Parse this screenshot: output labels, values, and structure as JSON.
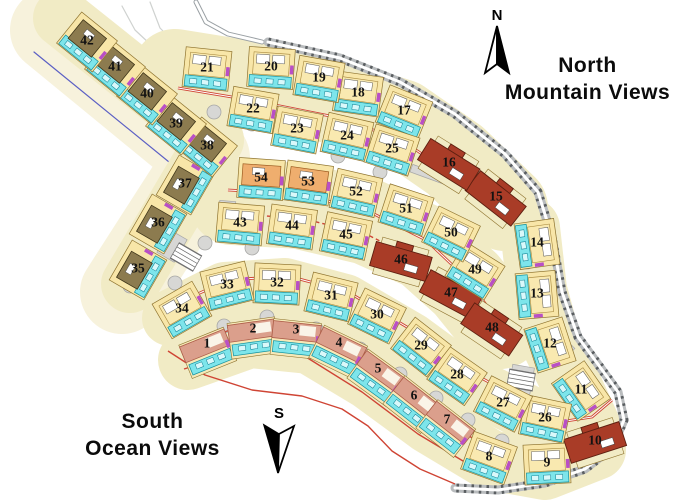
{
  "map": {
    "labels": {
      "north": {
        "line1": "North",
        "line2": "Mountain Views"
      },
      "south": {
        "line1": "South",
        "line2": "Ocean Views"
      },
      "compass_north": "N",
      "compass_south": "S"
    },
    "colors": {
      "ribbon": "#f1ebc5",
      "ribbon_light": "#f7f2dc",
      "cell": "#f8e6a8",
      "cell_stroke": "#8f7430",
      "building": "#f9e9b0",
      "building_stroke": "#a8883c",
      "terrace": "#7de5eb",
      "terrace_stroke": "#12919f",
      "olive": "#8c7b4f",
      "olive_stroke": "#3f3518",
      "orange": "#efae6e",
      "orange_stroke": "#9c5c20",
      "red": "#a93c27",
      "red_stroke": "#5d1f10",
      "salmon": "#db9f8c",
      "salmon_stroke": "#ae5d49",
      "red_line": "#cf4434",
      "magenta": "#b94fc6",
      "road_gray": "#b9bcbe",
      "road_dark": "#5a5e61",
      "circle_fill": "#d7d7d5",
      "circle_stroke": "#a8a8a6",
      "number": "#121212",
      "blue_edge": "#5b5fc4",
      "faint": "#cfd2d0"
    },
    "wedge": {
      "pts": [
        [
          52,
          30
        ],
        [
          208,
          158
        ],
        [
          122,
          292
        ]
      ],
      "w": 84
    },
    "blue_edge_pts": [
      [
        34,
        52
      ],
      [
        196,
        184
      ],
      [
        112,
        300
      ]
    ],
    "ribbons": [
      {
        "pts": [
          [
            62,
            18
          ],
          [
            215,
            140
          ]
        ],
        "w": 58
      },
      {
        "pts": [
          [
            215,
            140
          ],
          [
            130,
            284
          ]
        ],
        "w": 58
      },
      {
        "pts": [
          [
            175,
            72
          ],
          [
            250,
            84
          ],
          [
            330,
            100
          ],
          [
            400,
            122
          ],
          [
            455,
            160
          ],
          [
            505,
            208
          ]
        ],
        "w": 86
      },
      {
        "pts": [
          [
            232,
            202
          ],
          [
            300,
            206
          ],
          [
            368,
            222
          ],
          [
            426,
            248
          ],
          [
            466,
            284
          ],
          [
            500,
            326
          ]
        ],
        "w": 86
      },
      {
        "pts": [
          [
            530,
            228
          ],
          [
            537,
            290
          ],
          [
            552,
            345
          ],
          [
            574,
            390
          ],
          [
            590,
            425
          ]
        ],
        "w": 60
      },
      {
        "pts": [
          [
            170,
            318
          ],
          [
            225,
            290
          ],
          [
            285,
            286
          ],
          [
            345,
            302
          ],
          [
            410,
            340
          ],
          [
            470,
            384
          ],
          [
            542,
            420
          ]
        ],
        "w": 56
      },
      {
        "pts": [
          [
            188,
            360
          ],
          [
            250,
            338
          ],
          [
            310,
            344
          ],
          [
            370,
            380
          ],
          [
            430,
            424
          ],
          [
            490,
            460
          ],
          [
            545,
            470
          ],
          [
            596,
            450
          ]
        ],
        "w": 60
      }
    ],
    "roads": {
      "entrance": [
        [
          196,
          2
        ],
        [
          206,
          22
        ],
        [
          228,
          34
        ],
        [
          262,
          42
        ]
      ],
      "boundary": [
        [
          268,
          42
        ],
        [
          340,
          58
        ],
        [
          400,
          82
        ],
        [
          455,
          114
        ],
        [
          505,
          154
        ],
        [
          538,
          192
        ],
        [
          552,
          237
        ],
        [
          562,
          292
        ],
        [
          578,
          337
        ],
        [
          600,
          367
        ],
        [
          618,
          392
        ],
        [
          624,
          420
        ],
        [
          612,
          448
        ],
        [
          585,
          469
        ],
        [
          545,
          483
        ],
        [
          498,
          490
        ],
        [
          455,
          488
        ]
      ]
    },
    "faint_paths": [
      [
        [
          150,
          2
        ],
        [
          160,
          28
        ],
        [
          178,
          46
        ],
        [
          200,
          52
        ]
      ],
      [
        [
          122,
          6
        ],
        [
          135,
          30
        ],
        [
          150,
          44
        ],
        [
          168,
          52
        ]
      ]
    ],
    "red_lines": [
      {
        "pts": [
          [
            178,
            88
          ],
          [
            250,
            100
          ],
          [
            330,
            116
          ],
          [
            398,
            138
          ],
          [
            452,
            174
          ],
          [
            500,
            218
          ]
        ],
        "double": true
      },
      {
        "pts": [
          [
            228,
            190
          ],
          [
            298,
            194
          ],
          [
            366,
            210
          ],
          [
            426,
            240
          ],
          [
            466,
            278
          ],
          [
            496,
            318
          ]
        ],
        "double": true
      },
      {
        "pts": [
          [
            232,
            214
          ],
          [
            300,
            218
          ],
          [
            366,
            234
          ],
          [
            422,
            262
          ],
          [
            458,
            296
          ]
        ],
        "dashed": true
      },
      {
        "pts": [
          [
            176,
            304
          ],
          [
            228,
            280
          ],
          [
            288,
            276
          ],
          [
            348,
            292
          ],
          [
            412,
            330
          ],
          [
            474,
            374
          ],
          [
            540,
            410
          ]
        ],
        "double": true
      },
      {
        "pts": [
          [
            190,
            344
          ],
          [
            250,
            323
          ],
          [
            310,
            330
          ],
          [
            368,
            366
          ],
          [
            428,
            410
          ],
          [
            485,
            446
          ]
        ]
      },
      {
        "pts": [
          [
            184,
            369
          ],
          [
            246,
            350
          ],
          [
            306,
            357
          ],
          [
            362,
            392
          ],
          [
            418,
            434
          ],
          [
            468,
            464
          ]
        ]
      },
      {
        "pts": [
          [
            540,
            410
          ],
          [
            566,
            421
          ],
          [
            592,
            417
          ],
          [
            612,
            400
          ]
        ],
        "double": true
      },
      {
        "pts": [
          [
            70,
            42
          ],
          [
            208,
            156
          ]
        ]
      },
      {
        "pts": [
          [
            168,
            351
          ],
          [
            205,
            375
          ],
          [
            252,
            390
          ],
          [
            302,
            396
          ],
          [
            342,
            409
          ],
          [
            368,
            426
          ],
          [
            392,
            451
          ],
          [
            420,
            469
          ],
          [
            455,
            484
          ]
        ]
      }
    ],
    "circles": [
      [
        214,
        112
      ],
      [
        252,
        124
      ],
      [
        295,
        142
      ],
      [
        338,
        156
      ],
      [
        380,
        172
      ],
      [
        205,
        243
      ],
      [
        252,
        248
      ],
      [
        175,
        283
      ],
      [
        224,
        326
      ],
      [
        267,
        317
      ],
      [
        316,
        329
      ],
      [
        360,
        349
      ],
      [
        400,
        374
      ],
      [
        436,
        398
      ],
      [
        468,
        420
      ],
      [
        502,
        441
      ],
      [
        527,
        262
      ],
      [
        540,
        310
      ],
      [
        556,
        358
      ],
      [
        130,
        286
      ]
    ],
    "gray_patches": [
      {
        "x": 172,
        "y": 246,
        "w": 20,
        "h": 26,
        "a": 30
      },
      {
        "x": 227,
        "y": 210,
        "w": 16,
        "h": 18,
        "a": 5
      },
      {
        "x": 521,
        "y": 381,
        "w": 22,
        "h": 30,
        "a": 10
      },
      {
        "x": 560,
        "y": 352,
        "w": 16,
        "h": 26,
        "a": 45
      },
      {
        "x": 433,
        "y": 176,
        "w": 46,
        "h": 8,
        "a": 20
      }
    ],
    "parking": [
      {
        "x": 186,
        "y": 257,
        "a": 30
      },
      {
        "x": 521,
        "y": 380,
        "a": 10
      }
    ],
    "lots": [
      {
        "n": 1,
        "x": 207,
        "y": 347,
        "a": -22,
        "t": "s"
      },
      {
        "n": 2,
        "x": 253,
        "y": 332,
        "a": -8,
        "t": "s"
      },
      {
        "n": 3,
        "x": 296,
        "y": 333,
        "a": 6,
        "t": "s"
      },
      {
        "n": 4,
        "x": 339,
        "y": 346,
        "a": 26,
        "t": "s"
      },
      {
        "n": 5,
        "x": 378,
        "y": 372,
        "a": 36,
        "t": "s"
      },
      {
        "n": 6,
        "x": 414,
        "y": 399,
        "a": 38,
        "t": "s"
      },
      {
        "n": 7,
        "x": 447,
        "y": 423,
        "a": 38,
        "t": "s"
      },
      {
        "n": 8,
        "x": 489,
        "y": 456,
        "a": 20,
        "t": "y"
      },
      {
        "n": 9,
        "x": 547,
        "y": 462,
        "a": -3,
        "t": "y"
      },
      {
        "n": 10,
        "x": 595,
        "y": 440,
        "a": -18,
        "t": "r"
      },
      {
        "n": 11,
        "x": 581,
        "y": 389,
        "a": 55,
        "t": "y"
      },
      {
        "n": 12,
        "x": 550,
        "y": 343,
        "a": 72,
        "t": "y"
      },
      {
        "n": 13,
        "x": 537,
        "y": 293,
        "a": 85,
        "t": "y"
      },
      {
        "n": 14,
        "x": 537,
        "y": 242,
        "a": 82,
        "t": "y"
      },
      {
        "n": 15,
        "x": 496,
        "y": 196,
        "a": 38,
        "t": "r"
      },
      {
        "n": 16,
        "x": 449,
        "y": 162,
        "a": 32,
        "t": "r"
      },
      {
        "n": 17,
        "x": 404,
        "y": 110,
        "a": 22,
        "t": "y"
      },
      {
        "n": 18,
        "x": 358,
        "y": 92,
        "a": 8,
        "t": "y"
      },
      {
        "n": 19,
        "x": 319,
        "y": 77,
        "a": 10,
        "t": "y"
      },
      {
        "n": 20,
        "x": 271,
        "y": 66,
        "a": 4,
        "t": "y"
      },
      {
        "n": 21,
        "x": 207,
        "y": 67,
        "a": 6,
        "t": "y"
      },
      {
        "n": 22,
        "x": 253,
        "y": 108,
        "a": 10,
        "t": "y"
      },
      {
        "n": 23,
        "x": 297,
        "y": 128,
        "a": 11,
        "t": "y"
      },
      {
        "n": 24,
        "x": 347,
        "y": 135,
        "a": 13,
        "t": "y"
      },
      {
        "n": 25,
        "x": 392,
        "y": 148,
        "a": 18,
        "t": "y"
      },
      {
        "n": 26,
        "x": 545,
        "y": 417,
        "a": 12,
        "t": "y"
      },
      {
        "n": 27,
        "x": 503,
        "y": 402,
        "a": 27,
        "t": "y"
      },
      {
        "n": 28,
        "x": 457,
        "y": 374,
        "a": 35,
        "t": "y"
      },
      {
        "n": 29,
        "x": 421,
        "y": 345,
        "a": 38,
        "t": "y"
      },
      {
        "n": 30,
        "x": 377,
        "y": 314,
        "a": 26,
        "t": "y"
      },
      {
        "n": 31,
        "x": 331,
        "y": 295,
        "a": 14,
        "t": "y"
      },
      {
        "n": 32,
        "x": 277,
        "y": 282,
        "a": 3,
        "t": "y"
      },
      {
        "n": 33,
        "x": 227,
        "y": 284,
        "a": -14,
        "t": "y"
      },
      {
        "n": 34,
        "x": 182,
        "y": 308,
        "a": -30,
        "t": "y"
      },
      {
        "n": 35,
        "x": 138,
        "y": 268,
        "a": -60,
        "t": "o"
      },
      {
        "n": 36,
        "x": 158,
        "y": 222,
        "a": -60,
        "t": "o"
      },
      {
        "n": 37,
        "x": 185,
        "y": 183,
        "a": -60,
        "t": "o"
      },
      {
        "n": 38,
        "x": 207,
        "y": 145,
        "a": 39,
        "t": "o"
      },
      {
        "n": 39,
        "x": 176,
        "y": 123,
        "a": 39,
        "t": "o"
      },
      {
        "n": 40,
        "x": 147,
        "y": 93,
        "a": 39,
        "t": "o"
      },
      {
        "n": 41,
        "x": 115,
        "y": 66,
        "a": 39,
        "t": "o"
      },
      {
        "n": 42,
        "x": 87,
        "y": 40,
        "a": 39,
        "t": "o"
      },
      {
        "n": 43,
        "x": 240,
        "y": 222,
        "a": 5,
        "t": "y"
      },
      {
        "n": 44,
        "x": 292,
        "y": 225,
        "a": 8,
        "t": "y"
      },
      {
        "n": 45,
        "x": 346,
        "y": 234,
        "a": 12,
        "t": "y"
      },
      {
        "n": 46,
        "x": 401,
        "y": 259,
        "a": 16,
        "t": "r"
      },
      {
        "n": 47,
        "x": 451,
        "y": 292,
        "a": 28,
        "t": "r"
      },
      {
        "n": 48,
        "x": 492,
        "y": 327,
        "a": 34,
        "t": "r"
      },
      {
        "n": 49,
        "x": 475,
        "y": 269,
        "a": 32,
        "t": "y"
      },
      {
        "n": 50,
        "x": 451,
        "y": 232,
        "a": 26,
        "t": "y"
      },
      {
        "n": 51,
        "x": 406,
        "y": 208,
        "a": 18,
        "t": "y"
      },
      {
        "n": 52,
        "x": 356,
        "y": 191,
        "a": 13,
        "t": "y"
      },
      {
        "n": 53,
        "x": 308,
        "y": 181,
        "a": 8,
        "t": "o2"
      },
      {
        "n": 54,
        "x": 261,
        "y": 177,
        "a": 4,
        "t": "o2"
      }
    ]
  }
}
